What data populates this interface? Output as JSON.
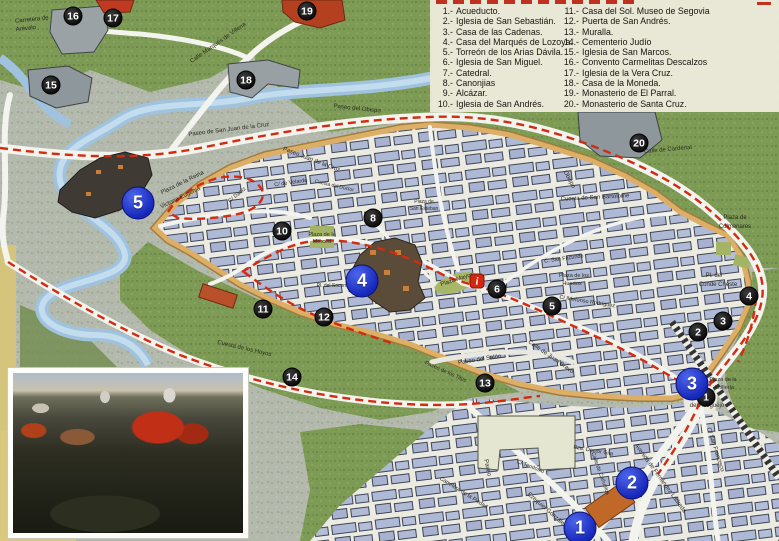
{
  "legend": {
    "items_left": [
      {
        "n": "1",
        "label": "Acueducto."
      },
      {
        "n": "2",
        "label": "Iglesia de San Sebastián."
      },
      {
        "n": "3",
        "label": "Casa de las Cadenas."
      },
      {
        "n": "4",
        "label": "Casa del Marqués de Lozoya."
      },
      {
        "n": "5",
        "label": "Torreón de los Arias Dávila."
      },
      {
        "n": "6",
        "label": "Iglesia de San Miguel."
      },
      {
        "n": "7",
        "label": "Catedral."
      },
      {
        "n": "8",
        "label": "Canonjias"
      },
      {
        "n": "9",
        "label": "Alcázar."
      },
      {
        "n": "10",
        "label": "Iglesia de San Andrés."
      }
    ],
    "items_right": [
      {
        "n": "11",
        "label": "Casa del Sol. Museo de Segovia"
      },
      {
        "n": "12",
        "label": "Puerta de San Andrés."
      },
      {
        "n": "13",
        "label": "Muralla."
      },
      {
        "n": "14",
        "label": "Cementerio Judío"
      },
      {
        "n": "15",
        "label": "Iglesia de San Marcos."
      },
      {
        "n": "16",
        "label": "Convento Carmelitas Descalzos"
      },
      {
        "n": "17",
        "label": "Iglesia de la Vera Cruz."
      },
      {
        "n": "18",
        "label": "Casa de la Moneda."
      },
      {
        "n": "19",
        "label": "Monasterio de El Parral."
      },
      {
        "n": "20",
        "label": "Monasterio de Santa Cruz."
      }
    ]
  },
  "map": {
    "colors": {
      "route_red": "#d42a10",
      "wall_orange": "#d8a55f",
      "river_blue": "#a9c9e2",
      "field_green": "#7e9b55",
      "building_blue": "#aeb9d6",
      "marker_black": "#141414",
      "marker_blue": "#1526ba",
      "info_red": "#d22810"
    },
    "info_marker": {
      "glyph": "i",
      "x": 477,
      "y": 281
    },
    "markers_small": [
      {
        "n": "1",
        "x": 706,
        "y": 397
      },
      {
        "n": "2",
        "x": 698,
        "y": 332
      },
      {
        "n": "3",
        "x": 723,
        "y": 321
      },
      {
        "n": "4",
        "x": 749,
        "y": 296
      },
      {
        "n": "5",
        "x": 552,
        "y": 306
      },
      {
        "n": "6",
        "x": 497,
        "y": 289
      },
      {
        "n": "8",
        "x": 373,
        "y": 218
      },
      {
        "n": "10",
        "x": 282,
        "y": 231
      },
      {
        "n": "11",
        "x": 263,
        "y": 309
      },
      {
        "n": "12",
        "x": 324,
        "y": 317
      },
      {
        "n": "13",
        "x": 485,
        "y": 383
      },
      {
        "n": "14",
        "x": 292,
        "y": 377
      },
      {
        "n": "15",
        "x": 51,
        "y": 85
      },
      {
        "n": "16",
        "x": 73,
        "y": 16
      },
      {
        "n": "17",
        "x": 113,
        "y": 18
      },
      {
        "n": "18",
        "x": 246,
        "y": 80
      },
      {
        "n": "19",
        "x": 307,
        "y": 11
      },
      {
        "n": "20",
        "x": 639,
        "y": 143
      }
    ],
    "markers_large": [
      {
        "n": "1",
        "x": 580,
        "y": 528
      },
      {
        "n": "2",
        "x": 632,
        "y": 483
      },
      {
        "n": "3",
        "x": 692,
        "y": 384
      },
      {
        "n": "4",
        "x": 362,
        "y": 281
      },
      {
        "n": "5",
        "x": 138,
        "y": 203
      }
    ],
    "labels": [
      {
        "t": "Carretera de",
        "x": 32,
        "y": 21,
        "r": -6,
        "s": 6
      },
      {
        "t": "Arévalo",
        "x": 26,
        "y": 30,
        "r": -6,
        "s": 6
      },
      {
        "t": "Calle Marqués de Villena",
        "x": 219,
        "y": 44,
        "r": -35,
        "s": 6
      },
      {
        "t": "Río",
        "x": 507,
        "y": 58,
        "r": 0,
        "s": 7.5,
        "b": 1
      },
      {
        "t": "Paseo de San Juan de la Cruz",
        "x": 229,
        "y": 131,
        "r": -7,
        "s": 6
      },
      {
        "t": "Paseo Juan de la Cruz",
        "x": 311,
        "y": 161,
        "r": 21,
        "s": 6
      },
      {
        "t": "Paseo del Obispo",
        "x": 357,
        "y": 110,
        "r": 6,
        "s": 6
      },
      {
        "t": "Obispo",
        "x": 568,
        "y": 180,
        "r": 62,
        "s": 6
      },
      {
        "t": "Cuesta de San Bartolomé",
        "x": 595,
        "y": 199,
        "r": -3,
        "s": 6
      },
      {
        "t": "Calle de Cardenal",
        "x": 668,
        "y": 151,
        "r": -5,
        "s": 6
      },
      {
        "t": "Plaza de",
        "x": 735,
        "y": 219,
        "r": 0,
        "s": 6
      },
      {
        "t": "Colmenares",
        "x": 735,
        "y": 228,
        "r": 0,
        "s": 6
      },
      {
        "t": "Pl. del",
        "x": 714,
        "y": 277,
        "r": 0,
        "s": 6
      },
      {
        "t": "Conde Cheste",
        "x": 718,
        "y": 286,
        "r": 0,
        "s": 6
      },
      {
        "t": "Plaza de los",
        "x": 574,
        "y": 277,
        "r": 0,
        "s": 5.5
      },
      {
        "t": "Huertos",
        "x": 572,
        "y": 285,
        "r": 0,
        "s": 5.5
      },
      {
        "t": "C/ Ildefonso Rodríguez",
        "x": 587,
        "y": 303,
        "r": 9,
        "s": 5.5
      },
      {
        "t": "C. San Facundo",
        "x": 564,
        "y": 260,
        "r": -8,
        "s": 5.5
      },
      {
        "t": "Cuesta de los Hoyos",
        "x": 244,
        "y": 350,
        "r": 13,
        "s": 6
      },
      {
        "t": "Paseo del Salón",
        "x": 480,
        "y": 361,
        "r": -9,
        "s": 6
      },
      {
        "t": "Paseo de los Tilos",
        "x": 445,
        "y": 373,
        "r": 24,
        "s": 5.5
      },
      {
        "t": "Plaza de la",
        "x": 322,
        "y": 236,
        "r": 0,
        "s": 5.5
      },
      {
        "t": "Merced",
        "x": 322,
        "y": 243,
        "r": 0,
        "s": 5.5
      },
      {
        "t": "Plaza Mayor",
        "x": 457,
        "y": 281,
        "r": -18,
        "s": 6
      },
      {
        "t": "Pl. del Socorro",
        "x": 333,
        "y": 287,
        "r": 0,
        "s": 5
      },
      {
        "t": "Plaza de",
        "x": 424,
        "y": 203,
        "r": 0,
        "s": 5
      },
      {
        "t": "San Esteban",
        "x": 424,
        "y": 210,
        "r": 0,
        "s": 5
      },
      {
        "t": "Plaza",
        "x": 702,
        "y": 399,
        "r": 0,
        "s": 6
      },
      {
        "t": "del Azoguejo",
        "x": 707,
        "y": 407,
        "r": 0,
        "s": 6
      },
      {
        "t": "Plaza de la",
        "x": 723,
        "y": 381,
        "r": 0,
        "s": 5.5
      },
      {
        "t": "Artillería",
        "x": 724,
        "y": 389,
        "r": 0,
        "s": 5.5
      },
      {
        "t": "Pza. Doctor Gila",
        "x": 593,
        "y": 452,
        "r": 10,
        "s": 5.5
      },
      {
        "t": "Calle de Cañuelos",
        "x": 599,
        "y": 474,
        "r": 70,
        "s": 5.5
      },
      {
        "t": "Avenida de Fernández Ladreda",
        "x": 659,
        "y": 479,
        "r": 54,
        "s": 6
      },
      {
        "t": "Ezequiel González",
        "x": 546,
        "y": 511,
        "r": 41,
        "s": 6
      },
      {
        "t": "Paseo",
        "x": 486,
        "y": 468,
        "r": 78,
        "s": 6
      },
      {
        "t": "C/ San Francisco",
        "x": 714,
        "y": 450,
        "r": 72,
        "s": 6
      },
      {
        "t": "Calle de Juan Bravo",
        "x": 550,
        "y": 358,
        "r": 35,
        "s": 6
      },
      {
        "t": "C/ Daoiz",
        "x": 238,
        "y": 196,
        "r": -40,
        "s": 5.5
      },
      {
        "t": "C/ de Velarde",
        "x": 291,
        "y": 184,
        "r": -8,
        "s": 5.5
      },
      {
        "t": "Cuesta del Doctor",
        "x": 334,
        "y": 187,
        "r": 13,
        "s": 5
      },
      {
        "t": "Plaza de la Reina",
        "x": 183,
        "y": 184,
        "r": -26,
        "s": 6
      },
      {
        "t": "Victoria Eugenia",
        "x": 181,
        "y": 199,
        "r": -26,
        "s": 6
      },
      {
        "t": "Carretera de la Piedad",
        "x": 463,
        "y": 494,
        "r": 32,
        "s": 5.5
      },
      {
        "t": "C/ Teodosio",
        "x": 530,
        "y": 468,
        "r": 21,
        "s": 5.5
      }
    ]
  }
}
